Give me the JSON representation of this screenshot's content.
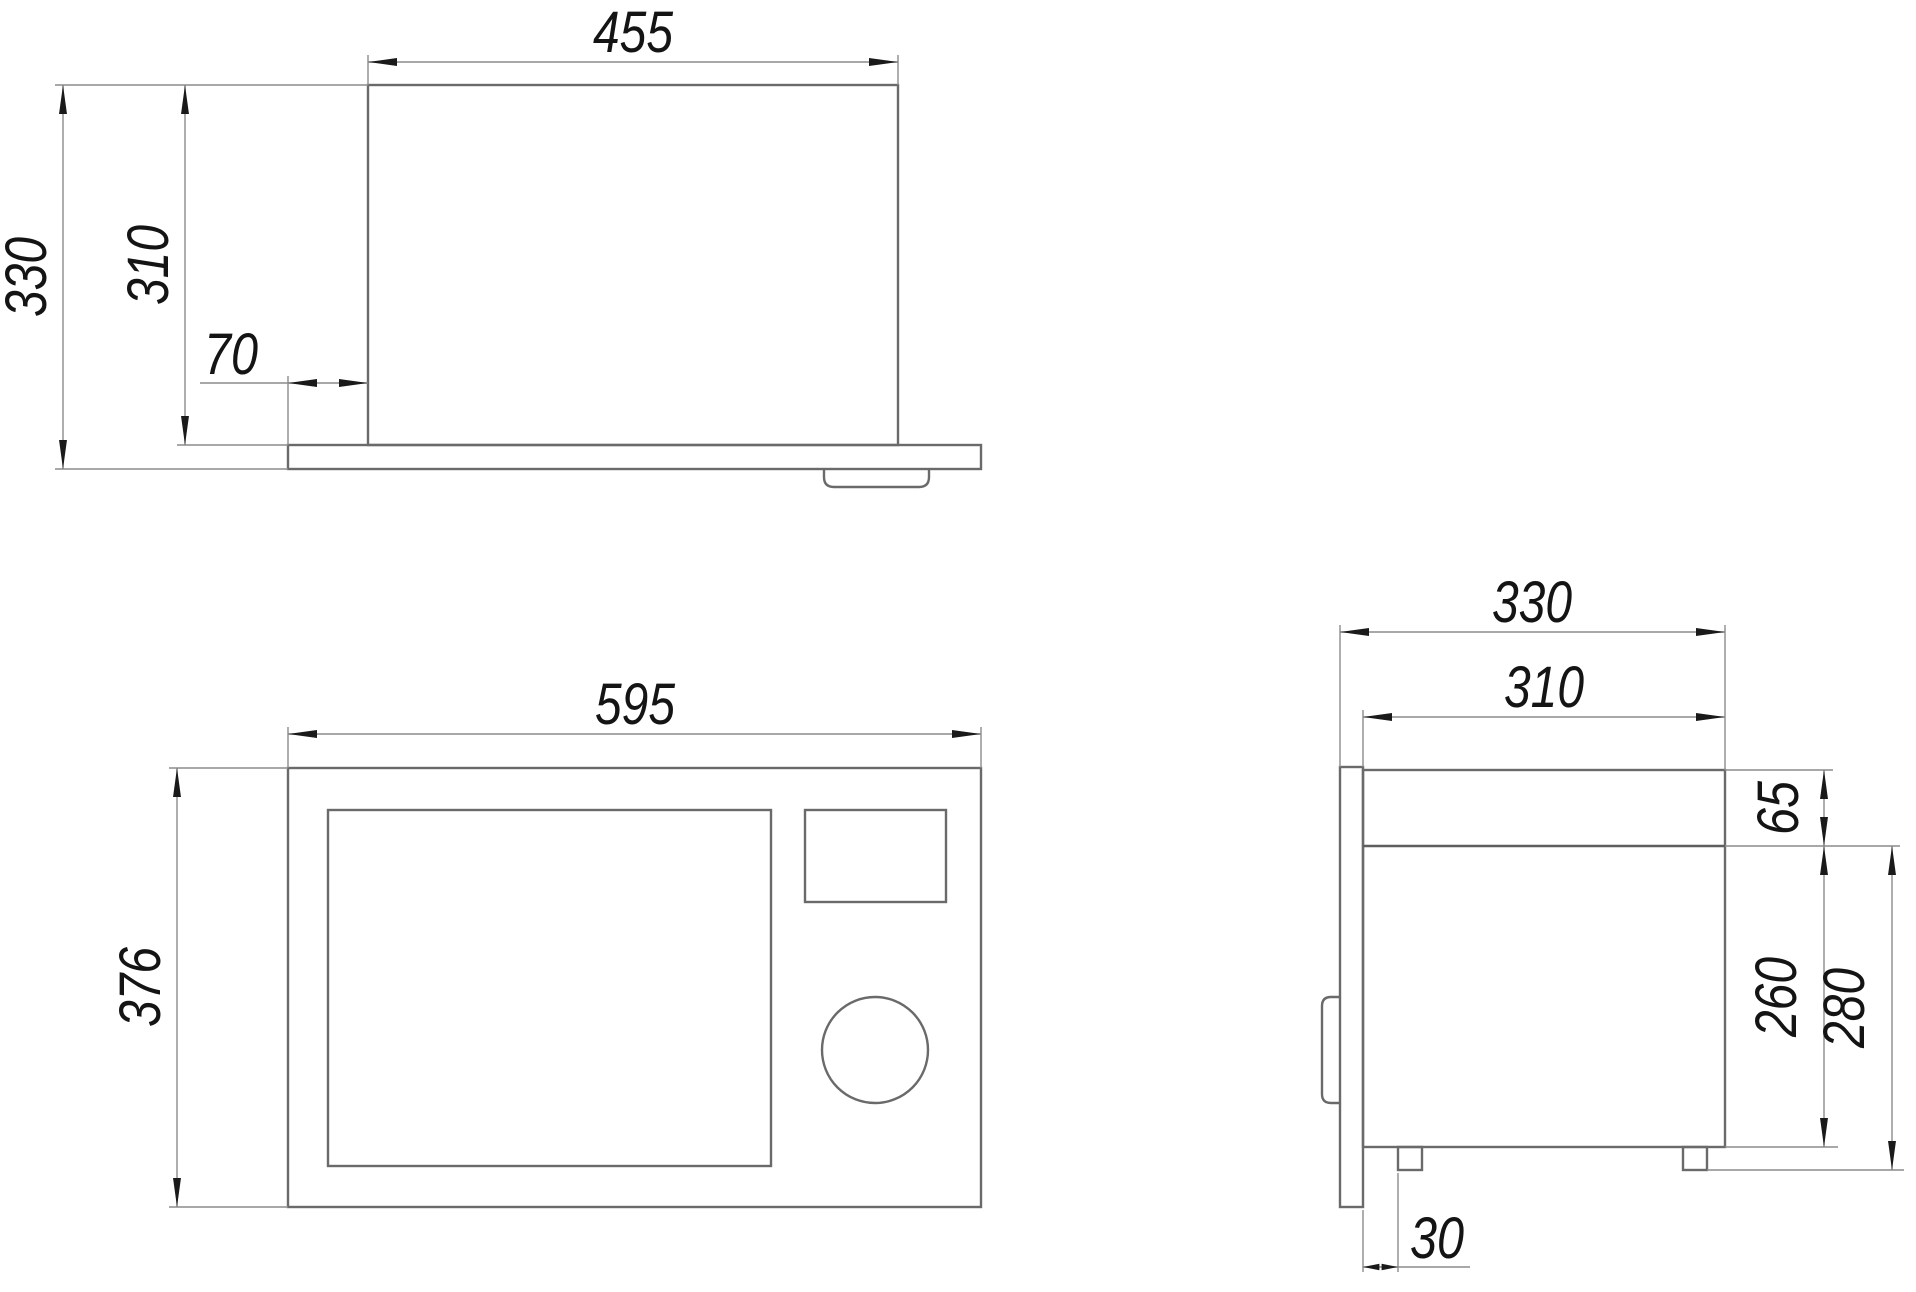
{
  "units": "mm",
  "colors": {
    "background": "#ffffff",
    "outline": "#6a6a6a",
    "dimension_lines": "#8c8c8c",
    "arrowheads": "#1a1a1a",
    "text": "#141414"
  },
  "views": {
    "top": {
      "dims": {
        "width": "455",
        "depth_total": "330",
        "depth_body": "310",
        "overhang": "70"
      }
    },
    "front": {
      "dims": {
        "width": "595",
        "height": "376"
      }
    },
    "side": {
      "dims": {
        "depth_total": "330",
        "depth_body": "310",
        "top_offset": "65",
        "front_height": "260",
        "front_height_with_feet": "280",
        "foot_setback": "30"
      }
    }
  }
}
